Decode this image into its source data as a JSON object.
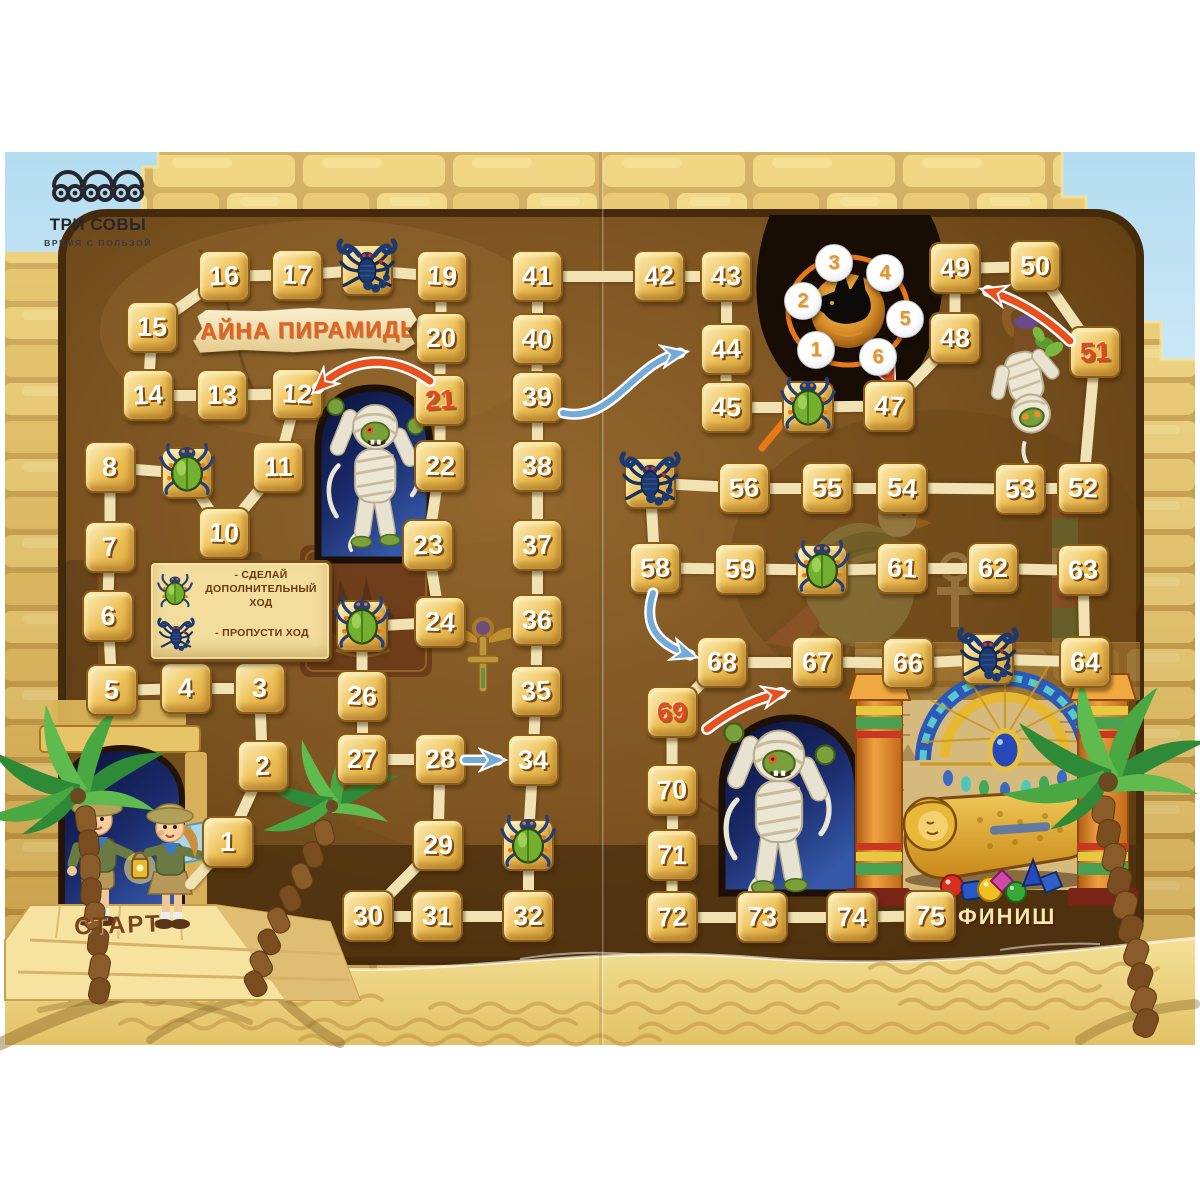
{
  "brand": {
    "logo": "ТРИ СОВЫ",
    "tagline": "ВРЕМЯ С ПОЛЬЗОЙ"
  },
  "title": "ТАЙНА ПИРАМИДЫ",
  "labels": {
    "start": "СТАРТ",
    "finish": "ФИНИШ"
  },
  "legend": {
    "scarab_rule": "- СДЕЛАЙ ДОПОЛНИТЕЛЬНЫЙ ХОД",
    "scorpion_rule": "- ПРОПУСТИ ХОД"
  },
  "spinner": {
    "numbers": [
      1,
      2,
      3,
      4,
      5,
      6
    ]
  },
  "board": {
    "tiles": [
      {
        "n": 1,
        "x": 228,
        "y": 842
      },
      {
        "n": 2,
        "x": 263,
        "y": 766
      },
      {
        "n": 3,
        "x": 260,
        "y": 688
      },
      {
        "n": 4,
        "x": 186,
        "y": 688
      },
      {
        "n": 5,
        "x": 112,
        "y": 690
      },
      {
        "n": 6,
        "x": 108,
        "y": 616
      },
      {
        "n": 7,
        "x": 110,
        "y": 547
      },
      {
        "n": 8,
        "x": 110,
        "y": 467
      },
      {
        "n": 9,
        "x": 187,
        "y": 473,
        "type": "scarab"
      },
      {
        "n": 10,
        "x": 224,
        "y": 533
      },
      {
        "n": 11,
        "x": 278,
        "y": 467
      },
      {
        "n": 12,
        "x": 297,
        "y": 394
      },
      {
        "n": 13,
        "x": 222,
        "y": 395
      },
      {
        "n": 14,
        "x": 148,
        "y": 395
      },
      {
        "n": 15,
        "x": 152,
        "y": 327
      },
      {
        "n": 16,
        "x": 224,
        "y": 276
      },
      {
        "n": 17,
        "x": 297,
        "y": 275
      },
      {
        "n": 18,
        "x": 367,
        "y": 270,
        "type": "scorpion"
      },
      {
        "n": 19,
        "x": 442,
        "y": 276
      },
      {
        "n": 20,
        "x": 441,
        "y": 338
      },
      {
        "n": 21,
        "x": 440,
        "y": 400,
        "type": "red"
      },
      {
        "n": 22,
        "x": 440,
        "y": 466
      },
      {
        "n": 23,
        "x": 428,
        "y": 545
      },
      {
        "n": 24,
        "x": 440,
        "y": 622
      },
      {
        "n": 25,
        "x": 362,
        "y": 626,
        "type": "scarab"
      },
      {
        "n": 26,
        "x": 362,
        "y": 696
      },
      {
        "n": 27,
        "x": 362,
        "y": 759
      },
      {
        "n": 28,
        "x": 440,
        "y": 759
      },
      {
        "n": 29,
        "x": 438,
        "y": 845
      },
      {
        "n": 30,
        "x": 368,
        "y": 916
      },
      {
        "n": 31,
        "x": 437,
        "y": 916
      },
      {
        "n": 32,
        "x": 528,
        "y": 916
      },
      {
        "n": 33,
        "x": 528,
        "y": 845,
        "type": "scarab"
      },
      {
        "n": 34,
        "x": 533,
        "y": 760
      },
      {
        "n": 35,
        "x": 536,
        "y": 691
      },
      {
        "n": 36,
        "x": 537,
        "y": 620
      },
      {
        "n": 37,
        "x": 537,
        "y": 545
      },
      {
        "n": 38,
        "x": 537,
        "y": 466
      },
      {
        "n": 39,
        "x": 537,
        "y": 397
      },
      {
        "n": 40,
        "x": 537,
        "y": 339
      },
      {
        "n": 41,
        "x": 537,
        "y": 276
      },
      {
        "n": 42,
        "x": 659,
        "y": 276
      },
      {
        "n": 43,
        "x": 726,
        "y": 276
      },
      {
        "n": 44,
        "x": 726,
        "y": 349
      },
      {
        "n": 45,
        "x": 726,
        "y": 407
      },
      {
        "n": 46,
        "x": 808,
        "y": 407,
        "type": "scarab"
      },
      {
        "n": 47,
        "x": 889,
        "y": 406
      },
      {
        "n": 48,
        "x": 955,
        "y": 338
      },
      {
        "n": 49,
        "x": 955,
        "y": 268
      },
      {
        "n": 50,
        "x": 1035,
        "y": 266
      },
      {
        "n": 51,
        "x": 1095,
        "y": 352,
        "type": "red"
      },
      {
        "n": 52,
        "x": 1083,
        "y": 488
      },
      {
        "n": 53,
        "x": 1020,
        "y": 489
      },
      {
        "n": 54,
        "x": 902,
        "y": 488
      },
      {
        "n": 55,
        "x": 827,
        "y": 488
      },
      {
        "n": 56,
        "x": 744,
        "y": 488
      },
      {
        "n": 57,
        "x": 650,
        "y": 483,
        "type": "scorpion"
      },
      {
        "n": 58,
        "x": 655,
        "y": 568
      },
      {
        "n": 59,
        "x": 740,
        "y": 569
      },
      {
        "n": 60,
        "x": 822,
        "y": 570,
        "type": "scarab"
      },
      {
        "n": 61,
        "x": 902,
        "y": 568
      },
      {
        "n": 62,
        "x": 993,
        "y": 568
      },
      {
        "n": 63,
        "x": 1083,
        "y": 570
      },
      {
        "n": 64,
        "x": 1085,
        "y": 662
      },
      {
        "n": 65,
        "x": 988,
        "y": 659,
        "type": "scorpion"
      },
      {
        "n": 66,
        "x": 908,
        "y": 663
      },
      {
        "n": 67,
        "x": 817,
        "y": 662
      },
      {
        "n": 68,
        "x": 722,
        "y": 662
      },
      {
        "n": 69,
        "x": 672,
        "y": 712,
        "type": "red"
      },
      {
        "n": 70,
        "x": 672,
        "y": 790
      },
      {
        "n": 71,
        "x": 672,
        "y": 855
      },
      {
        "n": 72,
        "x": 672,
        "y": 917
      },
      {
        "n": 73,
        "x": 762,
        "y": 917
      },
      {
        "n": 74,
        "x": 852,
        "y": 917
      },
      {
        "n": 75,
        "x": 930,
        "y": 916
      }
    ],
    "shortcuts": [
      {
        "from": 28,
        "to": 34
      },
      {
        "from": 39,
        "to": 44
      },
      {
        "from": 58,
        "to": 68
      }
    ],
    "penalties": [
      {
        "from": 21,
        "to": 12
      },
      {
        "from": 51,
        "to": 49
      },
      {
        "from": 69,
        "to": 67
      }
    ]
  },
  "colors": {
    "red_number": "#e8461c",
    "arrow_blue": "#74aad8",
    "arrow_orange": "#e8501e",
    "tile_gold": "#eec258",
    "path_cream": "#f0e2b2"
  }
}
